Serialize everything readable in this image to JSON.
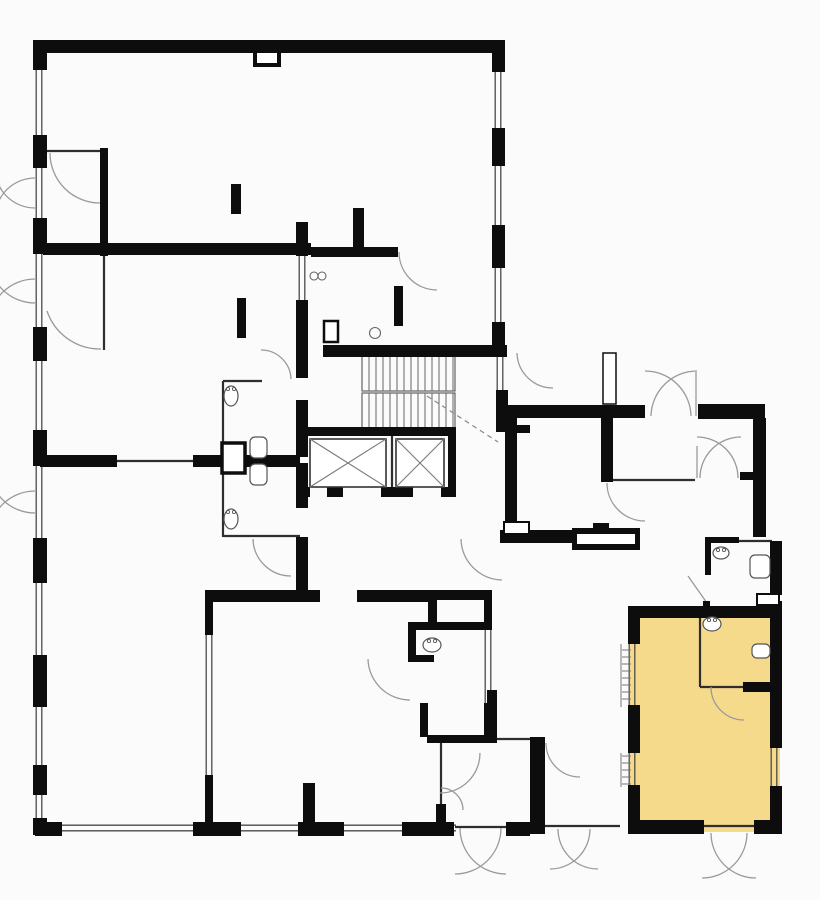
{
  "plan": {
    "canvas": {
      "width": 820,
      "height": 900
    },
    "colors": {
      "background": "#fbfbfb",
      "wall": "#0d0d0d",
      "line": "#2e2e2e",
      "window": "#4a4a4a",
      "arc": "#9a9a9a",
      "tick": "#777777",
      "highlight": "#f5da8c"
    },
    "highlight_room": {
      "x": 630,
      "y": 608,
      "w": 150,
      "h": 224
    },
    "walls": [
      [
        35,
        40,
        470,
        13
      ],
      [
        253,
        53,
        28,
        14
      ],
      [
        33,
        40,
        14,
        30
      ],
      [
        33,
        135,
        14,
        33
      ],
      [
        33,
        218,
        14,
        36
      ],
      [
        33,
        327,
        14,
        34
      ],
      [
        33,
        430,
        14,
        36
      ],
      [
        33,
        538,
        14,
        45
      ],
      [
        33,
        655,
        14,
        52
      ],
      [
        33,
        765,
        14,
        30
      ],
      [
        33,
        818,
        14,
        17
      ],
      [
        35,
        822,
        27,
        14
      ],
      [
        193,
        822,
        48,
        14
      ],
      [
        298,
        822,
        46,
        14
      ],
      [
        402,
        822,
        52,
        14
      ],
      [
        506,
        822,
        24,
        14
      ],
      [
        492,
        40,
        13,
        32
      ],
      [
        492,
        128,
        13,
        38
      ],
      [
        492,
        225,
        13,
        43
      ],
      [
        492,
        322,
        13,
        31
      ],
      [
        43,
        243,
        268,
        12
      ],
      [
        100,
        148,
        8,
        108
      ],
      [
        231,
        184,
        10,
        30
      ],
      [
        237,
        298,
        9,
        40
      ],
      [
        353,
        208,
        11,
        41
      ],
      [
        311,
        247,
        87,
        10
      ],
      [
        394,
        286,
        9,
        40
      ],
      [
        323,
        345,
        184,
        12
      ],
      [
        296,
        222,
        12,
        34
      ],
      [
        296,
        300,
        12,
        78
      ],
      [
        296,
        400,
        12,
        57
      ],
      [
        296,
        463,
        12,
        45
      ],
      [
        296,
        537,
        12,
        56
      ],
      [
        40,
        455,
        77,
        12
      ],
      [
        193,
        455,
        107,
        12
      ],
      [
        306,
        427,
        149,
        9
      ],
      [
        448,
        427,
        8,
        69
      ],
      [
        296,
        487,
        14,
        10
      ],
      [
        327,
        487,
        16,
        10
      ],
      [
        381,
        487,
        32,
        10
      ],
      [
        441,
        487,
        15,
        10
      ],
      [
        496,
        390,
        12,
        42
      ],
      [
        508,
        425,
        22,
        8
      ],
      [
        205,
        590,
        115,
        12
      ],
      [
        357,
        590,
        73,
        12
      ],
      [
        428,
        590,
        64,
        10
      ],
      [
        428,
        598,
        9,
        25
      ],
      [
        205,
        590,
        8,
        45
      ],
      [
        205,
        775,
        8,
        48
      ],
      [
        484,
        598,
        8,
        27
      ],
      [
        484,
        703,
        8,
        34
      ],
      [
        420,
        703,
        8,
        34
      ],
      [
        427,
        735,
        70,
        8
      ],
      [
        487,
        690,
        10,
        47
      ],
      [
        408,
        622,
        84,
        8
      ],
      [
        408,
        630,
        8,
        28
      ],
      [
        408,
        655,
        26,
        7
      ],
      [
        303,
        783,
        12,
        40
      ],
      [
        530,
        737,
        15,
        97
      ],
      [
        436,
        804,
        10,
        19
      ],
      [
        505,
        405,
        140,
        13
      ],
      [
        698,
        404,
        67,
        15
      ],
      [
        505,
        405,
        12,
        131
      ],
      [
        753,
        418,
        13,
        119
      ],
      [
        601,
        417,
        12,
        65
      ],
      [
        740,
        472,
        13,
        8
      ],
      [
        500,
        530,
        72,
        13
      ],
      [
        572,
        528,
        68,
        22
      ],
      [
        593,
        523,
        16,
        6
      ],
      [
        705,
        537,
        34,
        6
      ],
      [
        705,
        543,
        6,
        32
      ],
      [
        770,
        541,
        12,
        54
      ],
      [
        770,
        601,
        12,
        7
      ],
      [
        703,
        601,
        7,
        9
      ],
      [
        628,
        606,
        152,
        12
      ],
      [
        628,
        606,
        12,
        38
      ],
      [
        628,
        705,
        12,
        48
      ],
      [
        628,
        785,
        12,
        49
      ],
      [
        770,
        606,
        12,
        142
      ],
      [
        770,
        786,
        12,
        48
      ],
      [
        628,
        820,
        76,
        14
      ],
      [
        754,
        820,
        28,
        14
      ],
      [
        743,
        682,
        34,
        10
      ]
    ],
    "white_rects": [
      [
        257,
        53,
        20,
        10,
        0
      ],
      [
        222,
        443,
        23,
        30,
        3.5
      ],
      [
        324,
        321,
        14,
        21,
        2.5
      ],
      [
        603,
        353,
        13,
        51,
        1.5
      ],
      [
        504,
        522,
        25,
        12,
        2
      ],
      [
        577,
        534,
        58,
        10,
        0
      ],
      [
        757,
        594,
        22,
        11,
        2
      ]
    ],
    "windows": [
      [
        39,
        40,
        39,
        835
      ],
      [
        35,
        828,
        456,
        828
      ],
      [
        498,
        40,
        498,
        353
      ],
      [
        500,
        355,
        500,
        390
      ],
      [
        302,
        256,
        302,
        300
      ],
      [
        209,
        635,
        209,
        775
      ],
      [
        488,
        625,
        488,
        703
      ],
      [
        632,
        644,
        632,
        707
      ],
      [
        632,
        753,
        632,
        787
      ],
      [
        774,
        748,
        774,
        788
      ]
    ],
    "lines": [
      [
        47,
        151,
        100,
        151
      ],
      [
        104,
        256,
        104,
        350
      ],
      [
        117,
        461,
        193,
        461
      ],
      [
        223,
        381,
        223,
        537
      ],
      [
        223,
        381,
        262,
        381
      ],
      [
        223,
        536,
        300,
        536
      ],
      [
        392,
        436,
        392,
        487
      ],
      [
        613,
        480,
        695,
        480
      ],
      [
        737,
        541,
        772,
        541
      ],
      [
        441,
        743,
        441,
        806
      ],
      [
        497,
        739,
        530,
        739
      ],
      [
        455,
        827,
        530,
        827
      ],
      [
        545,
        826,
        620,
        826
      ],
      [
        702,
        826,
        756,
        826
      ],
      [
        700,
        617,
        700,
        687
      ],
      [
        700,
        687,
        744,
        687
      ]
    ],
    "leaf_lines": [
      [
        688,
        576,
        707,
        603
      ],
      [
        696,
        372,
        696,
        416
      ],
      [
        697,
        446,
        697,
        478
      ]
    ],
    "ticks": [
      [
        621,
        644,
        621,
        707
      ],
      [
        621,
        753,
        621,
        787
      ],
      [
        622,
        650,
        631,
        650
      ],
      [
        622,
        657,
        631,
        657
      ],
      [
        622,
        664,
        631,
        664
      ],
      [
        622,
        671,
        631,
        671
      ],
      [
        622,
        678,
        631,
        678
      ],
      [
        622,
        685,
        631,
        685
      ],
      [
        622,
        692,
        631,
        692
      ],
      [
        622,
        699,
        631,
        699
      ],
      [
        622,
        756,
        631,
        756
      ],
      [
        622,
        763,
        631,
        763
      ],
      [
        622,
        770,
        631,
        770
      ],
      [
        622,
        777,
        631,
        777
      ],
      [
        622,
        784,
        631,
        784
      ]
    ],
    "arcs": [
      "M 100 203 A 50 50 0 0 1 50 153",
      "M 47 311 A 56 56 0 0 0 101 349",
      "M 35 208 A 40 40 0 0 1 -5 168",
      "M 35 178 A 40 40 0 0 0 -5 218",
      "M 35 303 A 46 46 0 0 1 -11 257",
      "M 35 279 A 46 46 0 0 0 -11 325",
      "M 35 513 A 46 46 0 0 1 -11 467",
      "M 35 491 A 46 46 0 0 0 -11 537",
      "M 399 252 A 38 38 0 0 0 437 290",
      "M 291 379 A 30 30 0 0 0 261 350",
      "M 253 539 A 38 38 0 0 0 291 576",
      "M 517 353 A 36 36 0 0 0 553 388",
      "M 461 539 A 42 42 0 0 0 502 580",
      "M 480 753 A 40 40 0 0 1 440 793",
      "M 463 810 A 22 22 0 0 0 441 788",
      "M 546 743 A 34 34 0 0 0 580 777",
      "M 501 828 A 46 46 0 0 1 455 874",
      "M 460 828 A 46 46 0 0 0 506 874",
      "M 590 829 A 40 40 0 0 1 550 869",
      "M 558 829 A 40 40 0 0 0 598 869",
      "M 747 833 A 45 45 0 0 1 702 878",
      "M 711 833 A 45 45 0 0 0 756 878",
      "M 691 416 A 46 46 0 0 0 645 371",
      "M 651 416 A 46 46 0 0 1 697 371",
      "M 738 478 A 41 41 0 0 0 697 437",
      "M 700 478 A 41 41 0 0 1 741 437",
      "M 607 483 A 38 38 0 0 0 645 521",
      "M 368 659 A 42 42 0 0 0 410 700",
      "M 711 687 A 33 33 0 0 0 744 720"
    ],
    "dashed": [
      [
        427,
        396,
        498,
        442
      ]
    ],
    "stairs": [
      {
        "x": 362,
        "y": 356,
        "w": 93,
        "h": 35,
        "step": 7
      },
      {
        "x": 362,
        "y": 393,
        "w": 93,
        "h": 38,
        "step": 7
      }
    ],
    "elevators": [
      [
        310,
        439,
        76,
        48
      ],
      [
        396,
        439,
        48,
        48
      ]
    ],
    "sinks": [
      [
        231,
        396,
        7,
        10
      ],
      [
        231,
        519,
        7,
        10
      ],
      [
        432,
        645,
        9,
        7
      ],
      [
        712,
        624,
        9,
        7
      ],
      [
        721,
        553,
        8,
        6
      ]
    ],
    "toilets": [
      [
        250,
        437,
        17,
        21
      ],
      [
        250,
        464,
        17,
        21
      ],
      [
        750,
        555,
        20,
        23
      ],
      [
        752,
        644,
        18,
        14
      ]
    ],
    "circles": [
      [
        375,
        333,
        5.5
      ],
      [
        314,
        276,
        4
      ],
      [
        322,
        276,
        4
      ]
    ]
  }
}
